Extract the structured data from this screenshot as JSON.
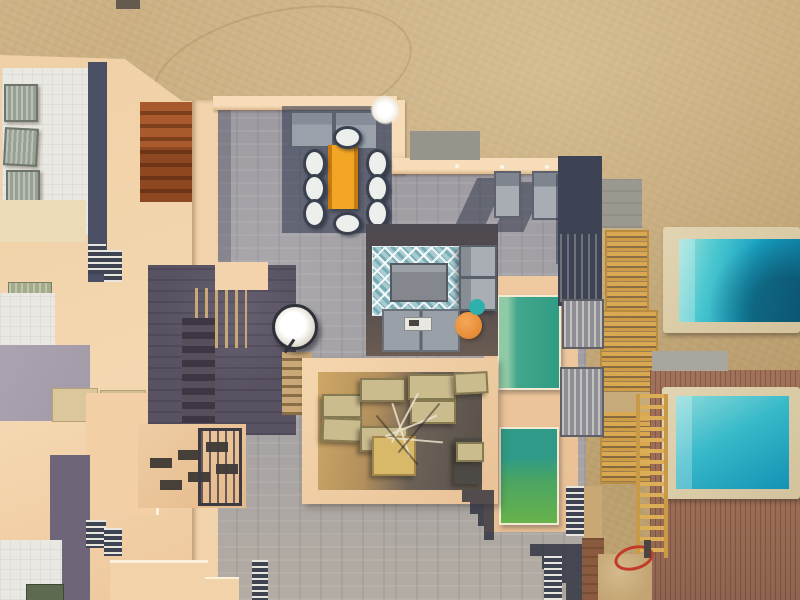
{
  "image": {
    "kind": "aerial drone photograph",
    "subject": "Top-down view of a seaside villa complex: peach-toned rooftops and walls, grey flagstone terraces, shaded courtyards, wooden pergolas, a timber pool deck and four swimming pools beside open sand",
    "lighting": "warm low sun with long shadows cast toward the lower left",
    "visible_text": "none"
  },
  "palette": {
    "sand": "#c7ab7b",
    "stone_terrace": "#a09da3",
    "peach_walls_roofs": "#f2d3ab",
    "white_gravel_roof": "#eae8e3",
    "shadow_navy": "#3d4254",
    "dark_slate_court": "#595263",
    "sienna_stairs": "#a85a2c",
    "lavender_paving": "#a7a0ac",
    "dining_table_orange": "#ef9a12",
    "rug_blue": "#a6cbd1",
    "pool_turquoise": "#17a0c2",
    "pool_green_teal": "#3aa287",
    "pool_green_bright": "#68b24c",
    "deck_brown": "#a1725a",
    "pergola_gold": "#d9a851",
    "khaki_furniture": "#cbbc8e",
    "pouf_orange": "#e07e28",
    "pouf_teal": "#2fb0ad",
    "hose_red": "#c33a28",
    "satellite_dish": "#f3f1ea"
  },
  "regions": {
    "sandGround": {
      "label": "open sand ground beside the villas"
    },
    "stoneTerrace": {
      "label": "grey flagstone terrace"
    },
    "leftBuildings": {
      "label": "villa rooftops with white gravel roofs and air-conditioning units"
    },
    "acUnit": {
      "label": "rooftop air-conditioning unit"
    },
    "siennaStairs": {
      "label": "sunlit terracotta stair block"
    },
    "darkZone": {
      "label": "shaded stairwell courtyard"
    },
    "satelliteDish": {
      "label": "satellite dish"
    },
    "diningShade": {
      "label": "pergola shade over outdoor dining area"
    },
    "diningTable": {
      "label": "orange outdoor dining table"
    },
    "diningChair": {
      "label": "dining chair with white cushion"
    },
    "whitePlant": {
      "label": "white flowering plant on wall corner"
    },
    "sunLounger": {
      "label": "grey sun lounger"
    },
    "loungeRug": {
      "label": "blue and white trellis-pattern outdoor rug"
    },
    "coffeeTable": {
      "label": "grey outdoor coffee table"
    },
    "loungeSofa": {
      "label": "grey outdoor sofa with serving tray"
    },
    "poufOrange": {
      "label": "round orange pouf"
    },
    "poufTeal": {
      "label": "round teal pouf"
    },
    "greenPoolUpper": {
      "label": "teal-green plunge pool in peach patio"
    },
    "greenPoolLower": {
      "label": "green plunge pool in peach patio"
    },
    "courtyard": {
      "label": "walled courtyard with khaki outdoor furniture and tree shadows"
    },
    "pergolaGold": {
      "label": "golden timber pergola slats"
    },
    "gate": {
      "label": "grey slatted gate"
    },
    "navyStructure": {
      "label": "dark shaded structure with slats"
    },
    "deck": {
      "label": "brown timber pool deck"
    },
    "turquoisePoolUpper": {
      "label": "turquoise swimming pool with stone coping"
    },
    "turquoisePoolLower": {
      "label": "turquoise swimming pool on timber deck"
    },
    "skylightRoof": {
      "label": "roof with skylight slots and railing"
    },
    "stepShadow": {
      "label": "stepped staircase shadow on paving"
    },
    "hose": {
      "label": "coiled red garden hose"
    }
  }
}
